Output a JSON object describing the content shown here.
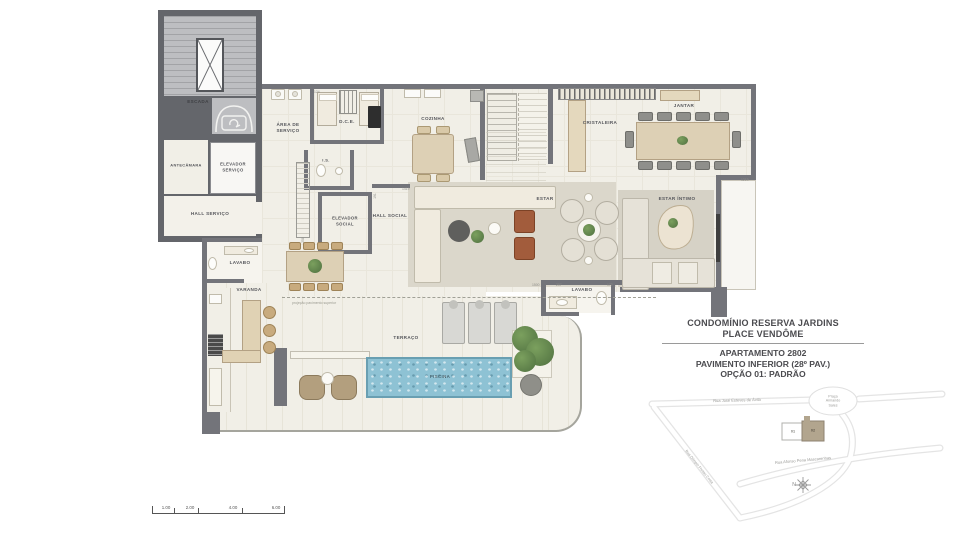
{
  "plan": {
    "rooms": {
      "escada": "ESCADA",
      "antecamara": "ANTECÂMARA",
      "elevador_servico": "ELEVADOR\nSERVIÇO",
      "hall_servico": "HALL SERVIÇO",
      "area_servico": "ÁREA DE\nSERVIÇO",
      "dce": "D.C.E.",
      "is": "I.S.",
      "cozinha": "COZINHA",
      "elevador_social": "ELEVADOR\nSOCIAL",
      "hall_social": "HALL SOCIAL",
      "lavabo_servico": "LAVABO",
      "varanda": "VARANDA",
      "cristaleira": "CRISTALEIRA",
      "jantar": "JANTAR",
      "estar": "ESTAR",
      "estar_intimo": "ESTAR ÍNTIMO",
      "lavabo_social": "LAVABO",
      "terraco": "TERRAÇO",
      "piscina": "PISCINA"
    },
    "annotations": {
      "projecao": "projeção pavimento superior"
    },
    "dimensions": {
      "d1": "1419",
      "d2": "191",
      "d3": "258",
      "d4": "1219",
      "d5": "1500",
      "d6": "207",
      "d7": "172",
      "d8": "124"
    }
  },
  "info": {
    "condo_line1": "CONDOMÍNIO RESERVA JARDINS",
    "condo_line2": "PLACE VENDÔME",
    "apartment": "APARTAMENTO 2802",
    "floor": "PAVIMENTO INFERIOR (28º PAV.)",
    "option": "OPÇÃO 01: PADRÃO"
  },
  "map": {
    "streets": {
      "jose": "Rua José Esteves de Ávila",
      "afonso": "Rua Afonso Pena Mascarenhas",
      "olimpio": "Rua Olímpio Freitas Costa",
      "praca": "Praça\nArmando\nSales"
    },
    "buildings": {
      "b01": "01",
      "b02": "02"
    },
    "compass": "N"
  },
  "scalebar": {
    "v1": "1.00",
    "v2": "2.00",
    "v3": "4.00",
    "v4": "6.00"
  },
  "colors": {
    "wall": "#73747a",
    "floor": "#f1efe7",
    "rug": "#d9d5c9",
    "pool": "#8ec2d4",
    "wood": "#ddd0b5",
    "green": "#5d8147"
  }
}
